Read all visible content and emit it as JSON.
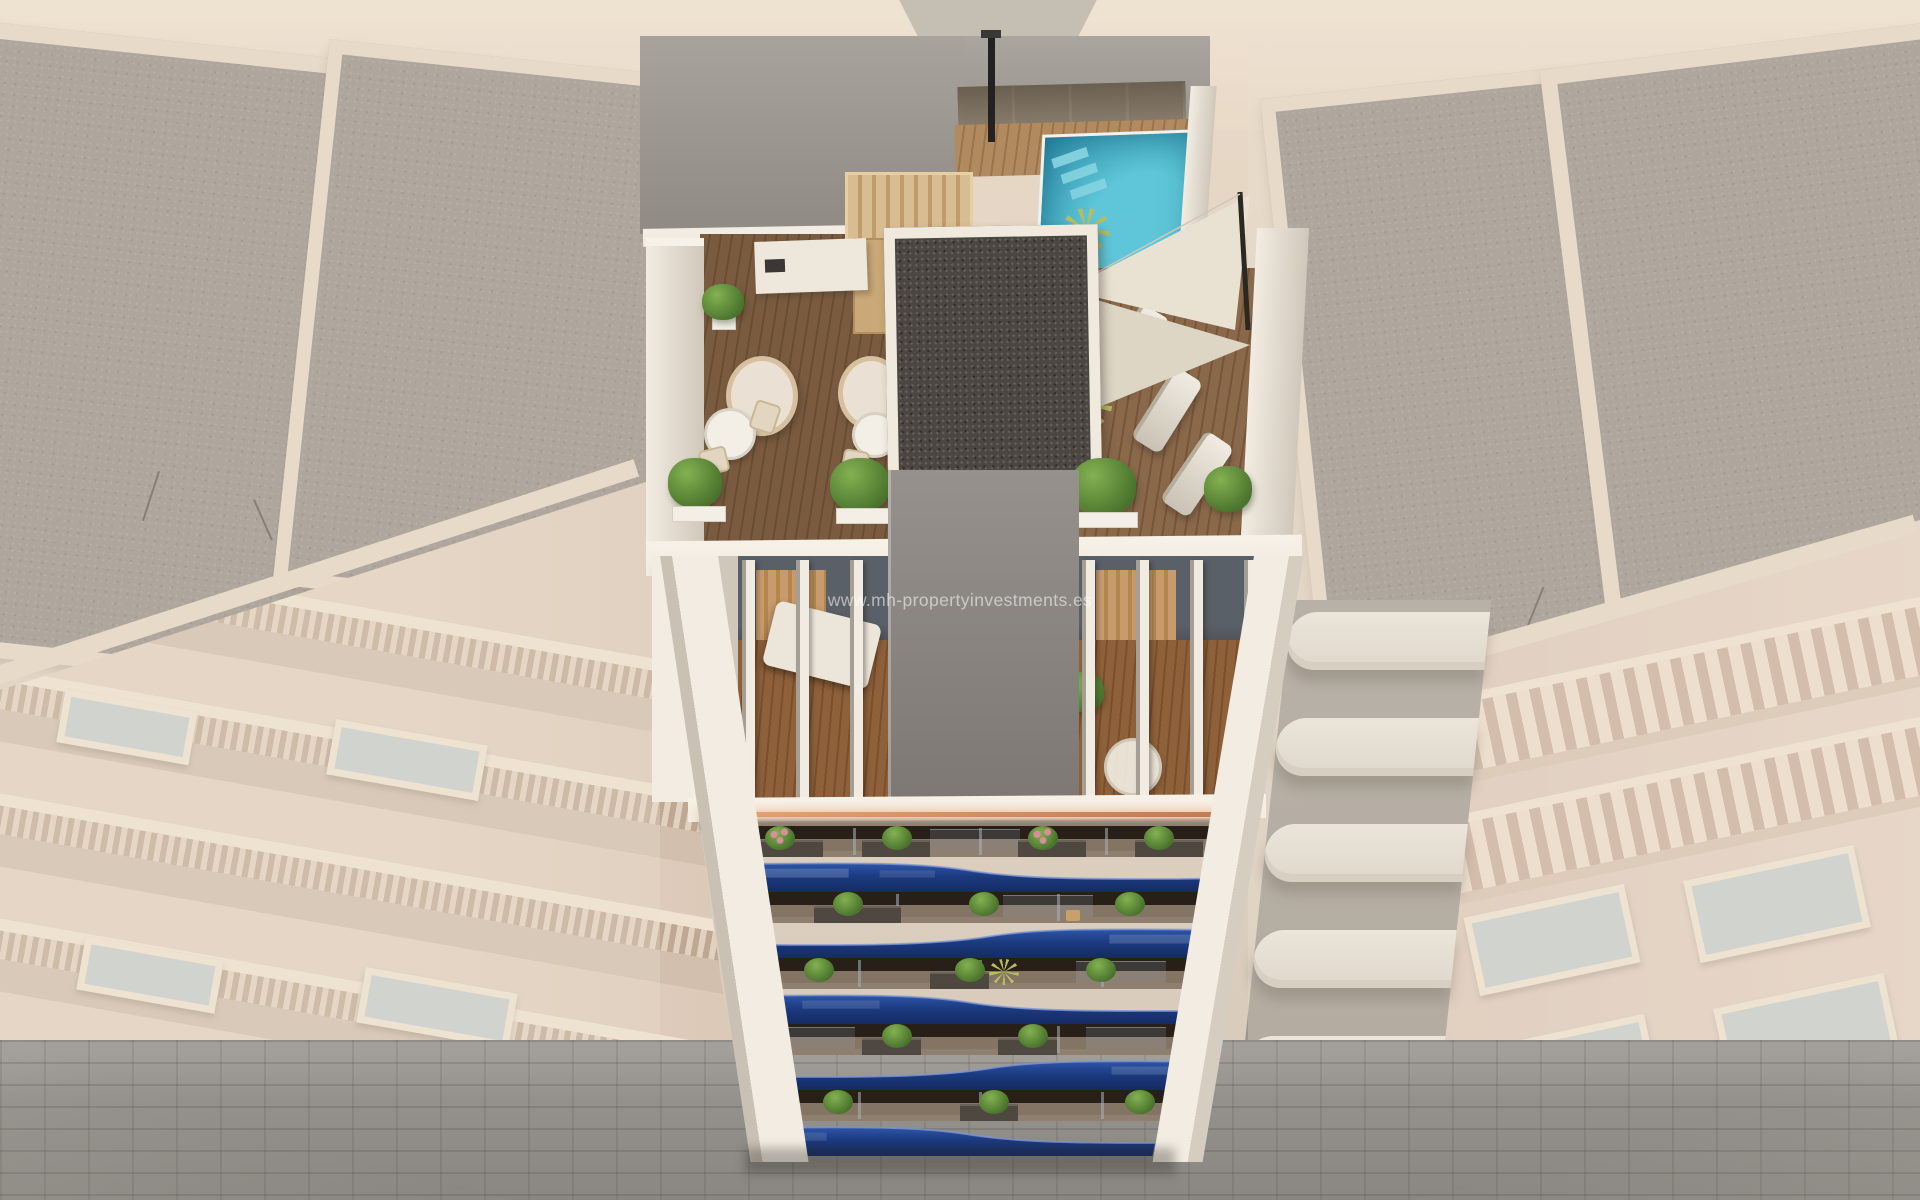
{
  "watermark": {
    "text": "www.mh-propertyinvestments.es"
  },
  "scene_summary": "Aerial 3D architectural render of a new-build apartment tower with rooftop pool, wooden roof terrace, glass-fenced solarium, gray elevator core, white-slatted penthouse level, five floors of wavy navy-blue glass balconies with plants, flanked by washed-out neighboring facades above a cobbled street",
  "palette": {
    "cream": "#e9d9c7",
    "creamLight": "#f0e3d2",
    "wallPale": "#d6cabb",
    "wallGray": "#a29d96",
    "gravel": "#968f88",
    "gravelDark": "#8a837c",
    "parapet": "#e7d7c5",
    "white": "#f2ece2",
    "whiteShade": "#cfc8ba",
    "pool": "#3fb0c6",
    "poolDeep": "#2a8aa6",
    "poolLight": "#8fd8e4",
    "deckDark": "#7a5b40",
    "deckDark2": "#684d34",
    "deckLight": "#b28a60",
    "deckLight2": "#9a744e",
    "pergola": "#d9bd92",
    "pergola2": "#c09b6d",
    "coreGray": "#8f8a86",
    "coreGray2": "#7d7874",
    "coreGravel": "#4b4641",
    "finWhite": "#f1ebe1",
    "finShadow": "#a49e95",
    "intCool": "#5a6068",
    "intDark": "#271f18",
    "intWood": "#8f613a",
    "intWood2": "#7a4f2c",
    "curtain": "#c89a6c",
    "led": "#e8a377",
    "led2": "#c07a50",
    "navyLight": "#2e56a8",
    "navy": "#1c3a80",
    "navyDark": "#152b62",
    "navyEdge": "#7e97d4",
    "glassDark": "#31363f",
    "balcFloor": "#847464",
    "planter": "#4e4840",
    "plant": "#49732c",
    "plantLight": "#84b152",
    "palm": "#b4bd62",
    "flower": "#d88f9a",
    "sail": "#e9e2d3",
    "sail2": "#ded6c5",
    "street": "#94918c",
    "streetDark": "#7b7873",
    "facadeL": "#e3d1c0",
    "facadeL2": "#d2bfae",
    "facadeR": "#e6d3c5",
    "facadeR2": "#c9ae9e",
    "frameGlass": "#c6cdcf",
    "curve": "#ece7de",
    "curveShadow": "#9b948a",
    "pole": "#2a2823",
    "haze": "#ece0d2"
  }
}
